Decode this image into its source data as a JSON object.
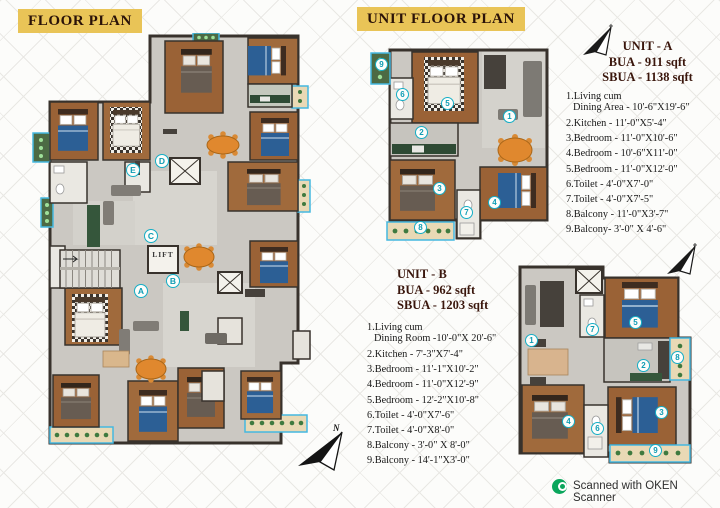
{
  "header": {
    "floor_plan_title": "FLOOR PLAN",
    "unit_floor_plan_title": "UNIT FLOOR PLAN"
  },
  "main_plan": {
    "lift_label": "LIFT",
    "north_label": "N",
    "markers": [
      "A",
      "B",
      "C",
      "D",
      "E"
    ]
  },
  "unit_markers": [
    "1",
    "2",
    "3",
    "4",
    "5",
    "6",
    "7",
    "8",
    "9"
  ],
  "unit_a": {
    "title": "UNIT - A",
    "bua": "BUA - 911 sqft",
    "sbua": "SBUA - 1138 sqft",
    "lines": [
      "1.Living cum",
      "Dining Area - 10'-6\"X19'-6\"",
      "2.Kitchen - 11'-0\"X5'-4\"",
      "3.Bedroom - 11'-0\"X10'-6\"",
      "4.Bedroom - 10'-6\"X11'-0\"",
      "5.Bedroom - 11'-0\"X12'-0\"",
      "6.Toilet - 4'-0\"X7'-0\"",
      "7.Toilet - 4'-0\"X7'-5\"",
      "8.Balcony - 11'-0\"X3'-7\"",
      "9.Balcony- 3'-0\"  X  4'-6\""
    ]
  },
  "unit_b": {
    "title": "UNIT - B",
    "bua": "BUA - 962 sqft",
    "sbua": "SBUA - 1203 sqft",
    "lines": [
      "1.Living cum",
      "Dining Room -10'-0\"X 20'-6\"",
      "2.Kitchen - 7'-3\"X7'-4\"",
      "3.Bedroom - 11'-1\"X10'-2\"",
      "4.Bedroom - 11'-0\"X12'-9\"",
      "5.Bedroom - 12'-2\"X10'-8\"",
      "6.Toilet - 4'-0\"X7'-6\"",
      "7.Toilet - 4'-0\"X8'-0\"",
      "8.Balcony - 3'-0\" X 8'-0\"",
      "9.Balcony - 14'-1\"X3'-0\""
    ]
  },
  "footer": {
    "scanner_label": "Scanned with OKEN Scanner"
  },
  "colors": {
    "highlight": "#e9c457",
    "wood": "#9a6236",
    "wall": "#38322c",
    "marker_teal": "#14aec6",
    "balcony_border": "#45b8e0",
    "table_orange": "#e0882e",
    "scanner_green": "#0aa65c"
  }
}
